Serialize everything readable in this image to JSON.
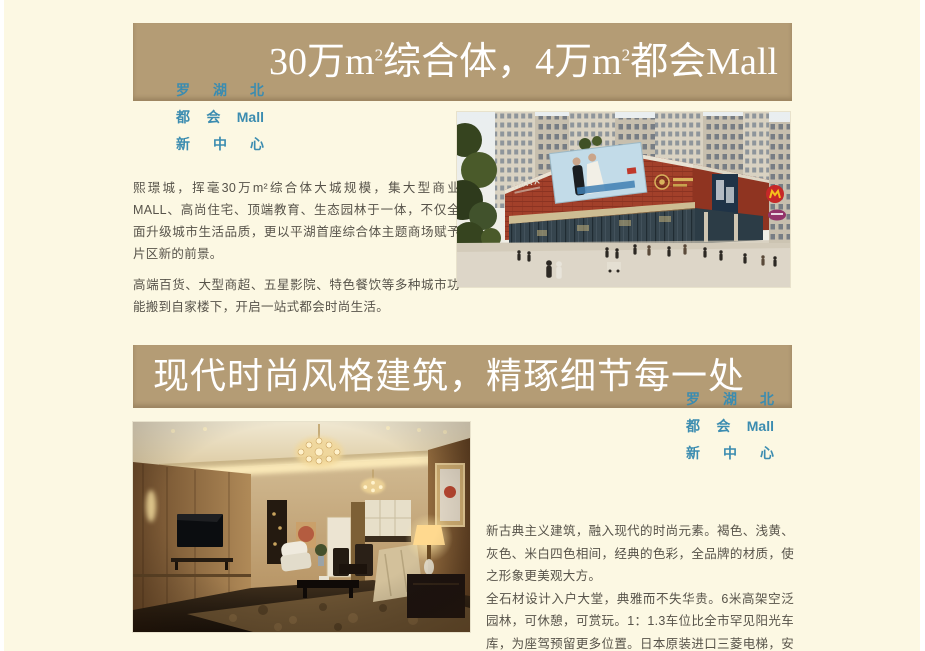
{
  "colors": {
    "background": "#fcf8e3",
    "banner": "#b49c75",
    "title_text": "#ffffff",
    "tagline_blue": "#3b8cb0",
    "body_text": "#57534a"
  },
  "tagline": {
    "lines": [
      [
        "罗",
        "湖",
        "北"
      ],
      [
        "都",
        "会",
        "Mall"
      ],
      [
        "新",
        "中",
        "心"
      ]
    ]
  },
  "mall_section": {
    "title": {
      "p1": "30万m",
      "sup1": "2",
      "p2": "综合体，4万m",
      "sup2": "2",
      "p3": "都会Mall"
    },
    "paragraphs": [
      "熙璟城，挥毫30万m²综合体大城规模，集大型商业MALL、高尚住宅、顶端教育、生态园林于一体，不仅全面升级城市生活品质，更以平湖首座综合体主题商场赋予片区新的前景。",
      "高端百货、大型商超、五星影院、特色餐饮等多种城市功能搬到自家楼下，开启一站式都会时尚生活。"
    ],
    "image": {
      "alt": "mall-exterior-rendering",
      "sign_imax": "IMAX"
    }
  },
  "design_section": {
    "title": "现代时尚风格建筑，精琢细节每一处",
    "paragraphs": [
      "新古典主义建筑，融入现代的时尚元素。褐色、浅黄、灰色、米白四色相间，经典的色彩，全品牌的材质，使之形象更美观大方。",
      "全石材设计入户大堂，典雅而不失华贵。6米高架空泛园林，可休憩，可赏玩。1：1.3车位比全市罕见阳光车库，为座驾预留更多位置。日本原装进口三菱电梯，安全性能更高，可靠性更强。"
    ],
    "image": {
      "alt": "living-room-interior-rendering"
    }
  }
}
